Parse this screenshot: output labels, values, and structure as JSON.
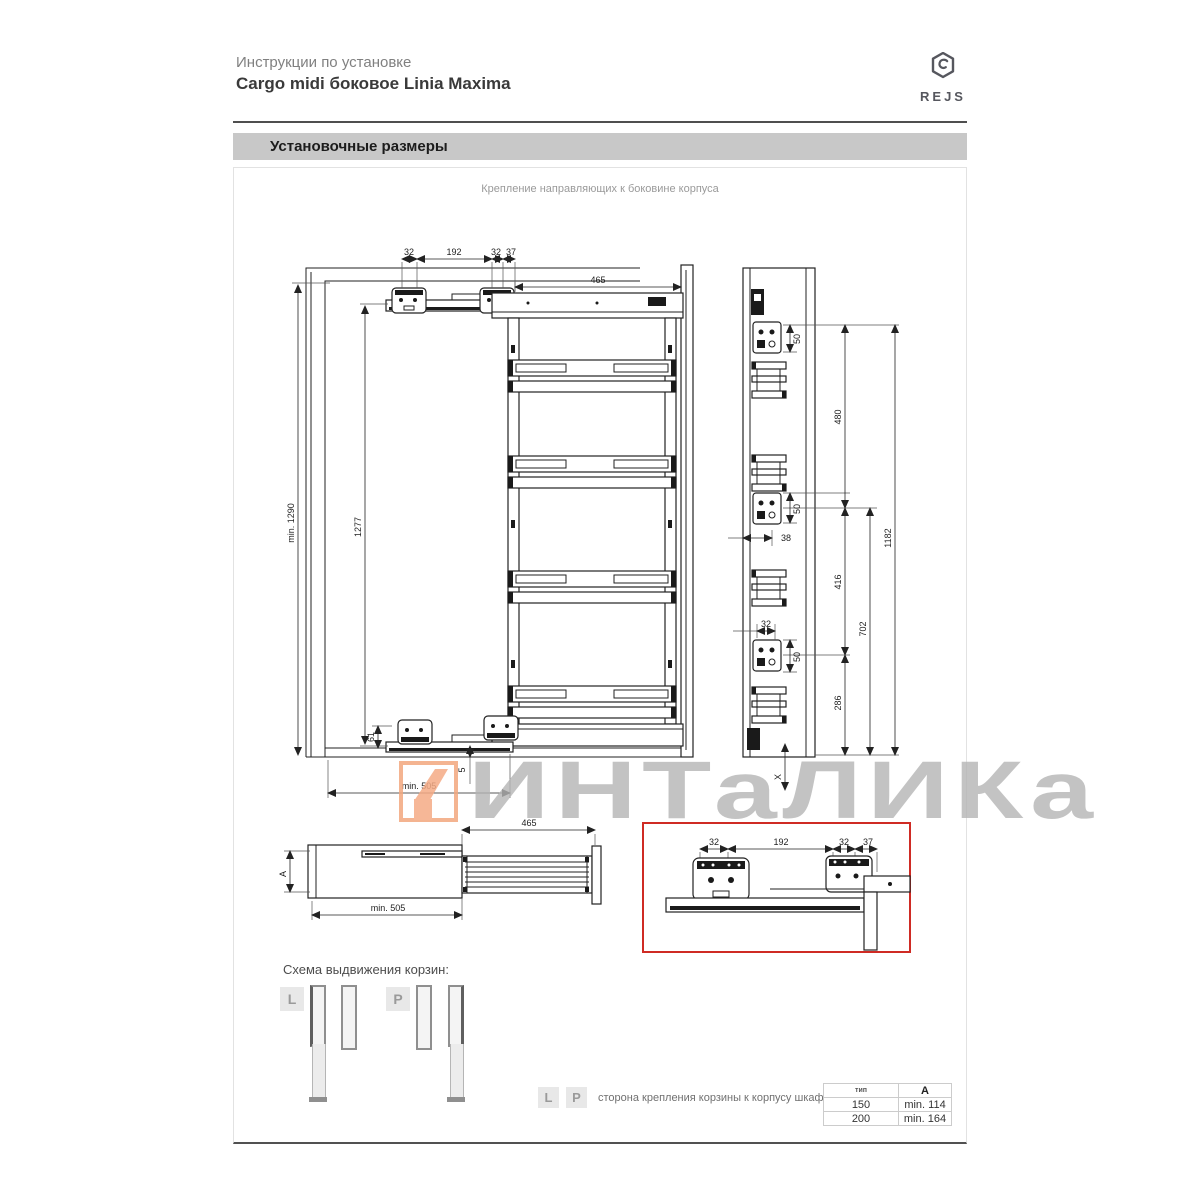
{
  "header": {
    "subtitle": "Инструкции по установке",
    "title": "Cargo midi боковое Linia Maxima",
    "brand": "REJS"
  },
  "section": {
    "bar_title": "Установочные размеры",
    "drawing_caption": "Крепление направляющих к боковине корпуса"
  },
  "dims": {
    "top_32_a": "32",
    "top_192": "192",
    "top_32_b": "32",
    "top_37": "37",
    "width_465": "465",
    "height_min": "min. 1290",
    "rail_height": "1277",
    "bottom_61": "61",
    "bottom_5": "5",
    "depth_min": "min. 505",
    "side_50_top": "50",
    "side_480": "480",
    "side_50_mid": "50",
    "side_38": "38",
    "side_416": "416",
    "side_32": "32",
    "side_50_bottom": "50",
    "side_286": "286",
    "side_702": "702",
    "side_1182": "1182",
    "side_x": "X",
    "pull_465": "465",
    "pull_a": "A",
    "pull_min_505": "min. 505",
    "detail_32_a": "32",
    "detail_192": "192",
    "detail_32_b": "32",
    "detail_37": "37"
  },
  "watermark": {
    "text": "ИНТаЛИКа"
  },
  "schema": {
    "heading": "Схема выдвижения корзин:",
    "left_label": "L",
    "right_label": "P"
  },
  "legend": {
    "l": "L",
    "p": "P",
    "text": "сторона крепления корзины к корпусу шкафа"
  },
  "table": {
    "headers": [
      "тип",
      "A"
    ],
    "rows": [
      [
        "150",
        "min. 114"
      ],
      [
        "200",
        "min. 164"
      ]
    ]
  },
  "colors": {
    "detail_box_red": "#cf2b24",
    "watermark_orange": "#f5ab85",
    "watermark_gray": "#b5b5b5",
    "section_bar_gray": "#c8c8c8"
  }
}
